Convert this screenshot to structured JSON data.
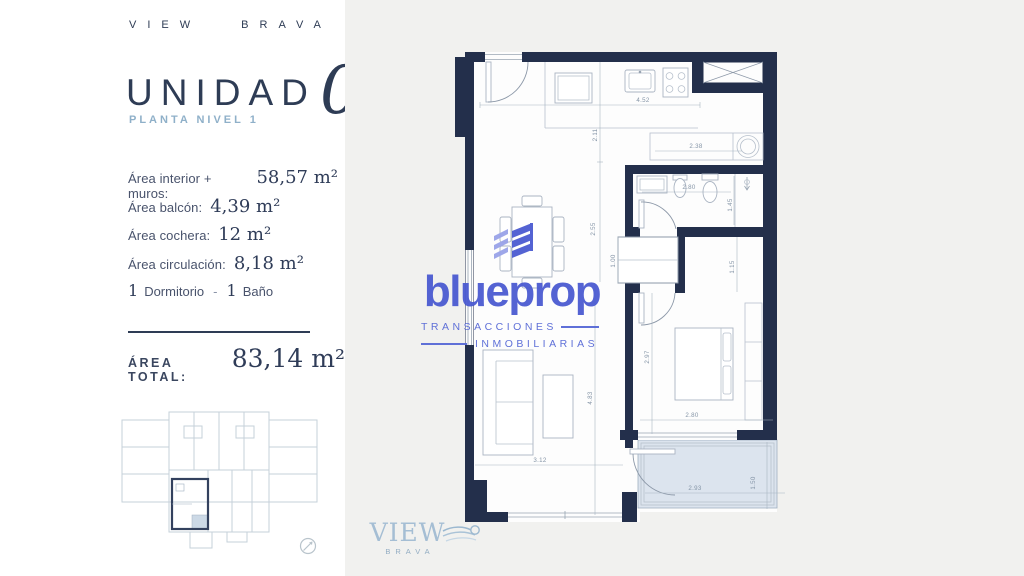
{
  "brand": {
    "top": "VIEW BRAVA"
  },
  "unit": {
    "title": "UNIDAD",
    "number": "05",
    "subtitle": "PLANTA NIVEL 1"
  },
  "details": {
    "rows": [
      {
        "label": "Área interior + muros:",
        "value": "58,57",
        "unit": "m²"
      },
      {
        "label": "Área balcón:",
        "value": "4,39",
        "unit": "m²"
      },
      {
        "label": "Área cochera:",
        "value": "12",
        "unit": "m²"
      },
      {
        "label": "Área circulación:",
        "value": "8,18",
        "unit": "m²"
      }
    ],
    "rooms": {
      "bedrooms_value": "1",
      "bedrooms_label": "Dormitorio",
      "separator": "-",
      "bathrooms_value": "1",
      "bathrooms_label": "Baño"
    }
  },
  "total": {
    "label": "ÁREA TOTAL:",
    "value": "83,14",
    "unit": "m²"
  },
  "watermark": {
    "name": "blueprop",
    "tagline1": "TRANSACCIONES",
    "tagline2": "INMOBILIARIAS",
    "accent_color": "#4a5ad1"
  },
  "footer_logo": {
    "name": "VIEW",
    "sub": "BRAVA"
  },
  "floorplan": {
    "wall_color": "#232f4b",
    "balcony_fill": "#dce4ee",
    "dimensions": [
      {
        "text": "4.52",
        "x": 188,
        "y": 57,
        "rot": 0
      },
      {
        "text": "2.11",
        "x": 142,
        "y": 90,
        "rot": -90
      },
      {
        "text": "2.38",
        "x": 241,
        "y": 103,
        "rot": 0
      },
      {
        "text": "2.80",
        "x": 234,
        "y": 144,
        "rot": 0
      },
      {
        "text": "1.45",
        "x": 277,
        "y": 160,
        "rot": -90
      },
      {
        "text": "2.55",
        "x": 140,
        "y": 184,
        "rot": -90
      },
      {
        "text": "1.00",
        "x": 160,
        "y": 216,
        "rot": -90
      },
      {
        "text": "1.15",
        "x": 279,
        "y": 222,
        "rot": -90
      },
      {
        "text": "2.97",
        "x": 194,
        "y": 312,
        "rot": -90
      },
      {
        "text": "4.83",
        "x": 137,
        "y": 353,
        "rot": -90
      },
      {
        "text": "2.80",
        "x": 237,
        "y": 372,
        "rot": 0
      },
      {
        "text": "3.12",
        "x": 85,
        "y": 417,
        "rot": 0
      },
      {
        "text": "2.93",
        "x": 240,
        "y": 445,
        "rot": 0
      },
      {
        "text": "1.50",
        "x": 300,
        "y": 438,
        "rot": -90
      }
    ]
  }
}
